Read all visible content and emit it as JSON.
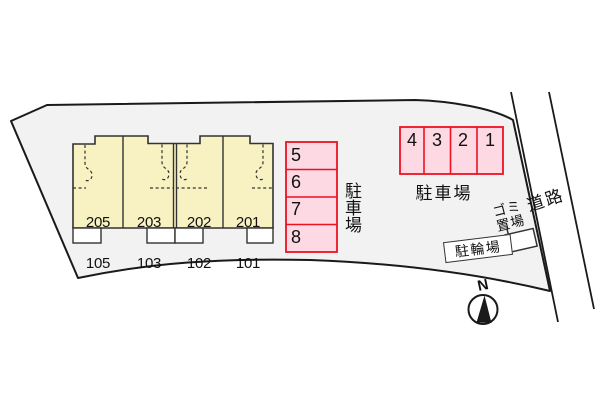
{
  "title": "apartment site plan",
  "colors": {
    "property_fill": "#f2f2f2",
    "boundary_stroke": "#1a1a1a",
    "building_fill": "#f8f2c2",
    "building_stroke": "#333333",
    "porch_fill": "#ffffff",
    "parking_fill": "#fcd9e3",
    "parking_stroke": "#ee1122",
    "text": "#111111"
  },
  "building": {
    "units": [
      {
        "upper": "205",
        "lower": "105"
      },
      {
        "upper": "203",
        "lower": "103"
      },
      {
        "upper": "202",
        "lower": "102"
      },
      {
        "upper": "201",
        "lower": "101"
      }
    ]
  },
  "parking_column": {
    "label": "駐車場",
    "spaces": [
      "5",
      "6",
      "7",
      "8"
    ]
  },
  "parking_row": {
    "label": "駐車場",
    "spaces": [
      "4",
      "3",
      "2",
      "1"
    ]
  },
  "road": {
    "label": "道路"
  },
  "garbage_area": {
    "label": "ゴミ置場"
  },
  "bicycle_parking": {
    "label": "駐輪場"
  },
  "compass": {
    "label": "N"
  }
}
